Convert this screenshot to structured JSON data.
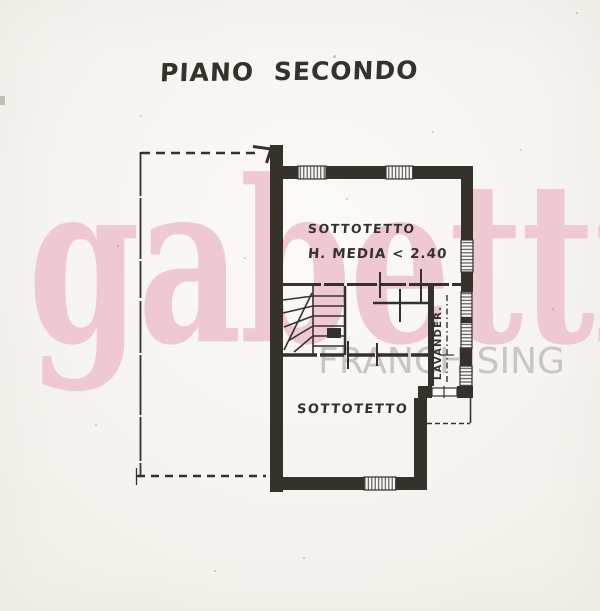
{
  "title": "PIANO SECONDO",
  "paper": {
    "color": "#f7f5f1"
  },
  "plan": {
    "ink_color": "#35322c",
    "rooms": {
      "upper": {
        "label": "SOTTOTETTO",
        "note": "H. MEDIA < 2.40"
      },
      "lower": {
        "label": "SOTTOTETTO"
      },
      "laundry": {
        "label": "LAVANDER."
      }
    }
  },
  "watermark": {
    "brand": "gabetti",
    "subtitle": "FRANCHISING",
    "brand_color": "#eec9d1",
    "subtitle_color": "#c9c5c6"
  }
}
